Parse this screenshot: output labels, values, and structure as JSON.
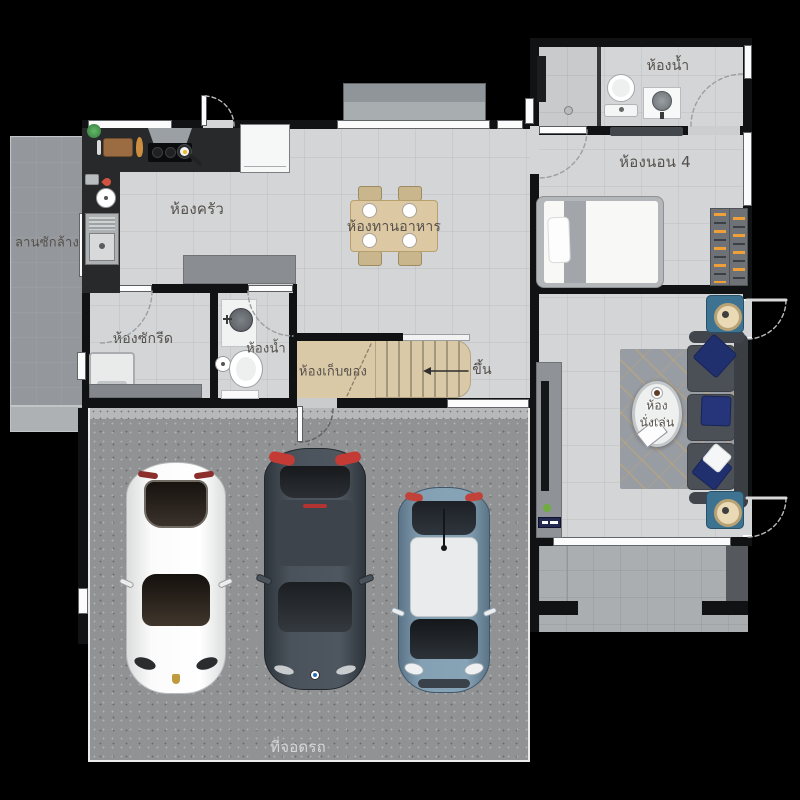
{
  "title": "House floor plan (first floor)",
  "labels": {
    "washing_yard": "ลานซักล้าง",
    "kitchen": "ห้องครัว",
    "dining": "ห้องทานอาหาร",
    "bathroom_top": "ห้องน้ำ",
    "bedroom4": "ห้องนอน 4",
    "laundry": "ห้องซักรีด",
    "bathroom_mid": "ห้องน้ำ",
    "storage": "ห้องเก็บของ",
    "stairs_up": "ขึ้น",
    "living_line1": "ห้อง",
    "living_line2": "นั่งเล่น",
    "garage": "ที่จอดรถ"
  },
  "colors": {
    "background": "#000000",
    "wall": "#101214",
    "floor": "#d3d5d7",
    "washing_yard": "#94989c",
    "garage_concrete": "#909294",
    "terrace": "#abaeb1",
    "wood_stairs": "#d9c9a6",
    "kitchen_counter": "#28292b",
    "sofa": "#4b5056",
    "pillow_navy": "#20306f",
    "speaker_teal": "#3d7290",
    "hanger_orange": "#ef9f3a",
    "car_white": "#f4f4f4",
    "car_dark_gray": "#434b54",
    "car_blue": "#7b94a7"
  }
}
